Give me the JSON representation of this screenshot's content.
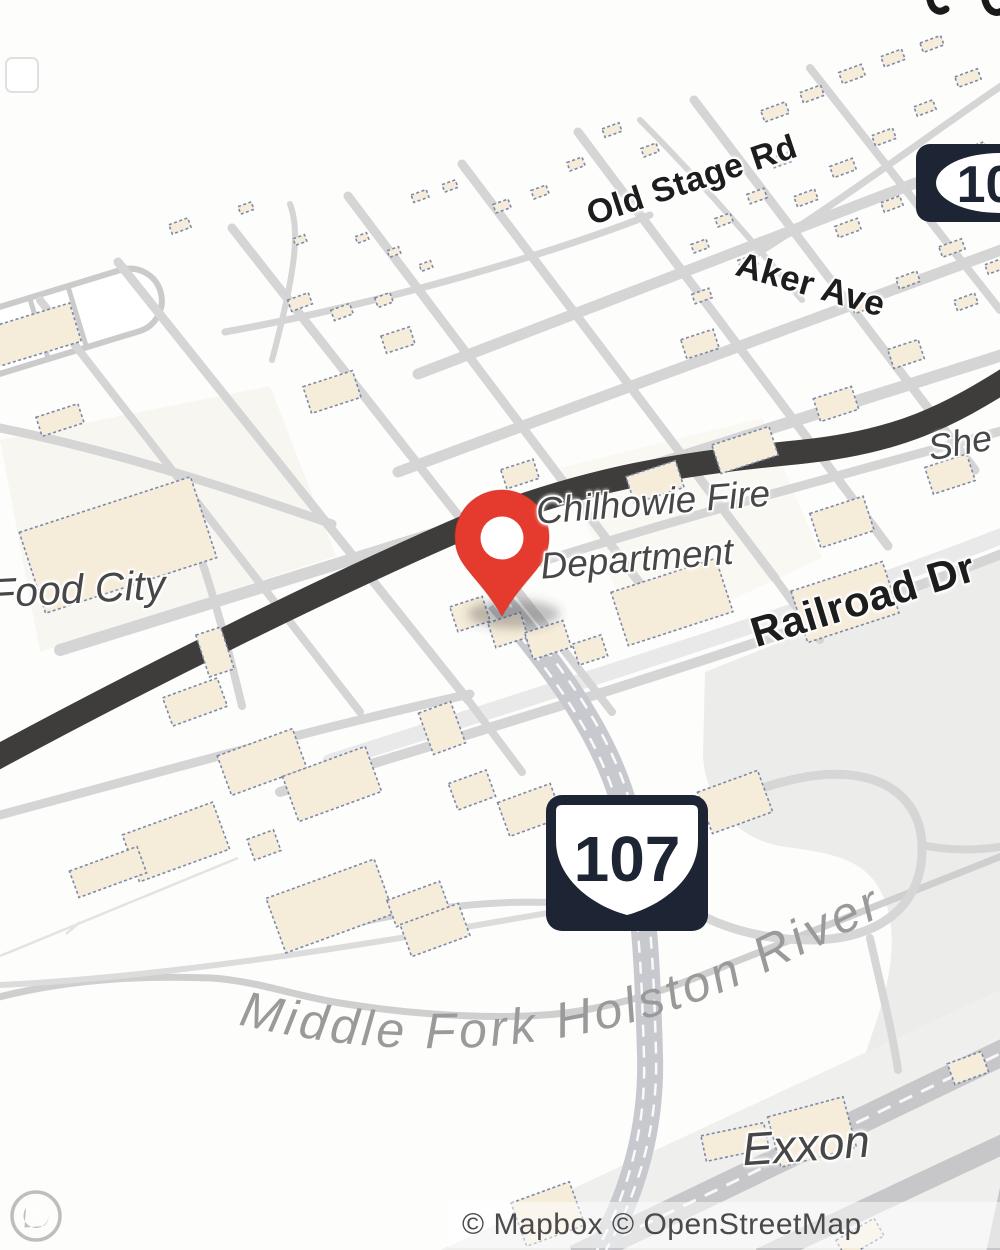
{
  "map": {
    "marker": {
      "name": "dropped-pin",
      "color": "#e53a2e"
    },
    "poi_labels": [
      {
        "id": "fire-department",
        "line1": "Chilhowie Fire",
        "line2": "Department"
      },
      {
        "id": "food-city",
        "text": "Food City"
      },
      {
        "id": "exxon",
        "text": "Exxon"
      },
      {
        "id": "clipped-poi",
        "text": "She"
      }
    ],
    "street_labels": [
      {
        "id": "old-stage-rd",
        "text": "Old Stage Rd"
      },
      {
        "id": "aker-ave",
        "text": "Aker Ave"
      },
      {
        "id": "railroad-dr",
        "text": "Railroad Dr"
      }
    ],
    "water_label": "Middle Fork Holston River",
    "route_shields": [
      {
        "id": "route-107-main",
        "number": "107"
      },
      {
        "id": "route-107-corner",
        "number": "107"
      }
    ],
    "attribution": "© Mapbox © OpenStreetMap",
    "colors": {
      "building_fill": "#f6ecda",
      "building_outline": "#7c89aa",
      "road_minor": "#d5d5d6",
      "road_major_dark": "#3f3d3c",
      "river_valley": "#ececeb",
      "shield_dark": "#1d2433",
      "water_label_gray": "#9a9a9a"
    }
  }
}
